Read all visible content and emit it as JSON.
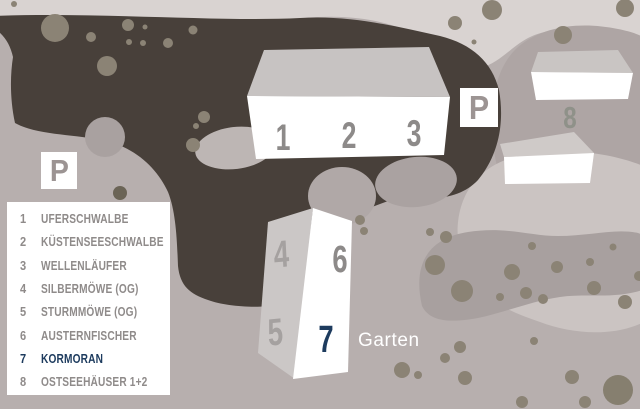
{
  "legend": {
    "items": [
      {
        "num": "1",
        "label": "UFERSCHWALBE",
        "highlighted": false
      },
      {
        "num": "2",
        "label": "KÜSTENSEESCHWALBE",
        "highlighted": false
      },
      {
        "num": "3",
        "label": "WELLENLÄUFER",
        "highlighted": false
      },
      {
        "num": "4",
        "label": "SILBERMÖWE (OG)",
        "highlighted": false
      },
      {
        "num": "5",
        "label": "STURMMÖWE (OG)",
        "highlighted": false
      },
      {
        "num": "6",
        "label": "AUSTERNFISCHER",
        "highlighted": false
      },
      {
        "num": "7",
        "label": "KORMORAN",
        "highlighted": true
      },
      {
        "num": "8",
        "label": "OSTSEEHÄUSER 1+2",
        "highlighted": false
      }
    ]
  },
  "map": {
    "garten_label": "Garten",
    "parking_sign_label": "P",
    "building_numbers": {
      "n1": "1",
      "n2": "2",
      "n3": "3",
      "n4": "4",
      "n5": "5",
      "n6": "6",
      "n7": "7",
      "n8": "8"
    },
    "highlighted_unit": "7"
  },
  "colors": {
    "background_mauve": "#b7afae",
    "top_band_light": "#d9d3d1",
    "terrain_dark_brown": "#48403a",
    "light_blob": "#cbc4c2",
    "medium_blob": "#a8a09f",
    "dot_olive": "#8b8375",
    "building_white": "#ffffff",
    "building_top_gray": "#c7c3c2",
    "number_gray": "#8d8a89",
    "highlight_navy": "#1d3b5e",
    "legend_text_gray": "#8f8b8a"
  }
}
